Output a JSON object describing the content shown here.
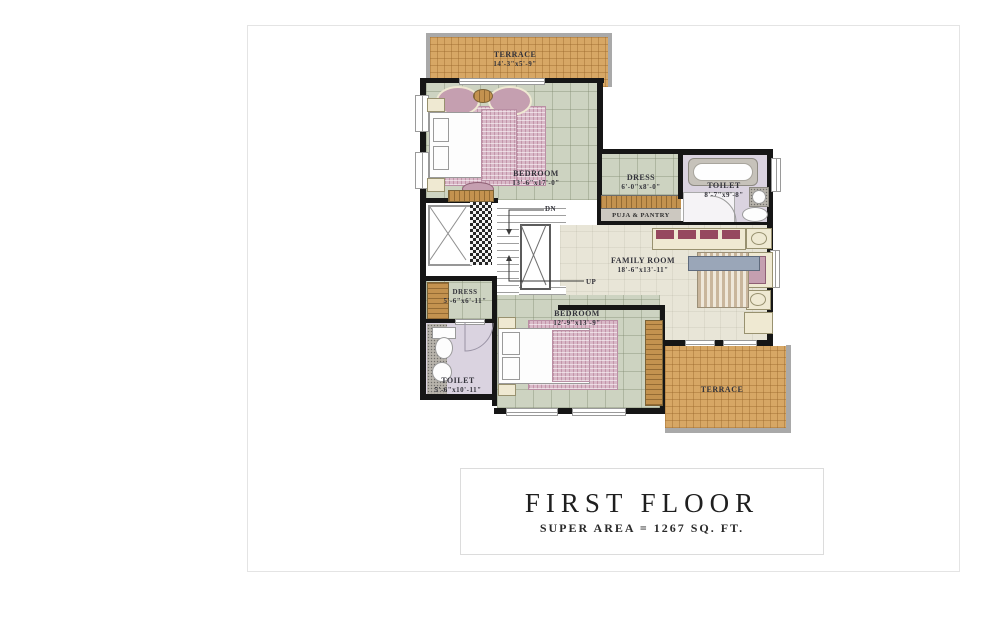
{
  "title_block": {
    "title": "FIRST FLOOR",
    "subtitle": "SUPER AREA = 1267 SQ. FT."
  },
  "rooms": {
    "terrace_top": {
      "name": "TERRACE",
      "dims": "14'-3\"x5'-9\""
    },
    "bedroom1": {
      "name": "BEDROOM",
      "dims": "13'-6\"x17'-0\""
    },
    "dress1": {
      "name": "DRESS",
      "dims": "6'-0\"x8'-0\""
    },
    "toilet1": {
      "name": "TOILET",
      "dims": "8'-7\"x9'-8\""
    },
    "puja_pantry": {
      "name": "PUJA & PANTRY"
    },
    "family_room": {
      "name": "FAMILY ROOM",
      "dims": "18'-6\"x13'-11\""
    },
    "dress2": {
      "name": "DRESS",
      "dims": "5'-6\"x6'-11\""
    },
    "bedroom2": {
      "name": "BEDROOM",
      "dims": "12'-9\"x13'-9\""
    },
    "toilet2": {
      "name": "TOILET",
      "dims": "5'-6\"x10'-11\""
    },
    "terrace_bottom": {
      "name": "TERRACE"
    }
  },
  "stairs": {
    "down_label": "DN",
    "up_label": "UP"
  },
  "colors": {
    "wall": "#161616",
    "tile_floor": "#cdd3c1",
    "terrace_brick": "#d7a765",
    "toilet_floor": "#dad3e0",
    "family_floor": "#e8e5d7",
    "furniture_pink": "#c59fb0",
    "accent_pink": "#8e5f74",
    "wood": "#c3924f",
    "label_text": "#33333b"
  }
}
